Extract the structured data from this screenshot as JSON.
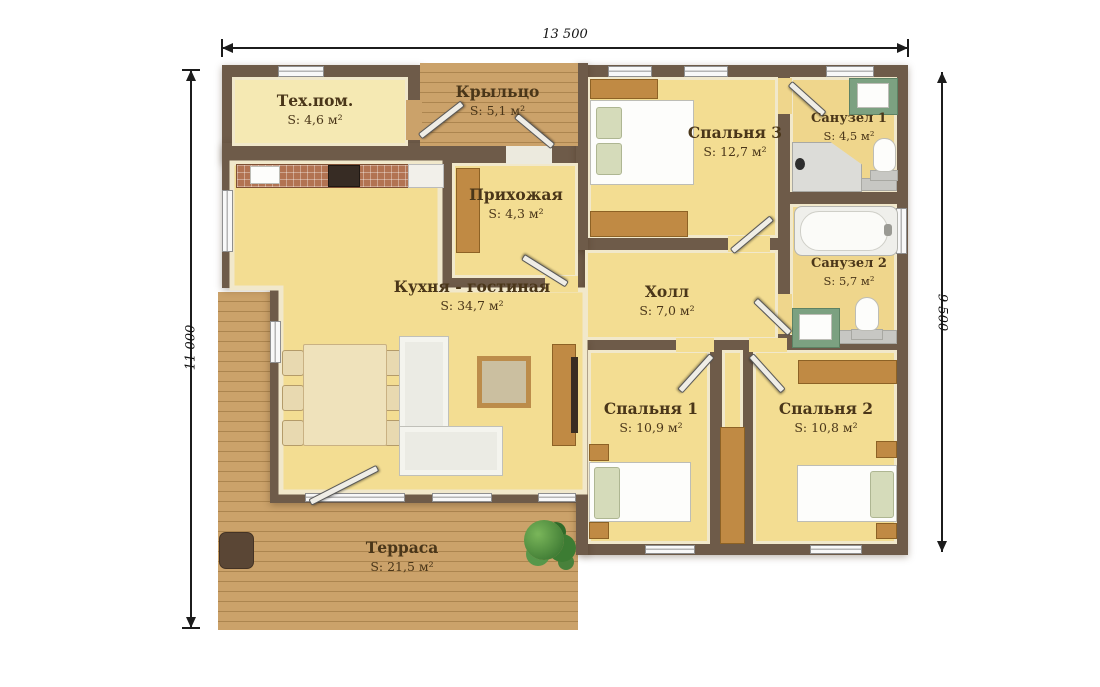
{
  "plan": {
    "title_hint": "house floor plan",
    "dimensions": {
      "top": "13 500",
      "left": "11 000",
      "right": "9 500"
    },
    "rooms": [
      {
        "id": "tech",
        "name": "Тех.пом.",
        "area": "S: 4,6 м²"
      },
      {
        "id": "porch",
        "name": "Крыльцо",
        "area": "S: 5,1 м²"
      },
      {
        "id": "hallway",
        "name": "Прихожая",
        "area": "S: 4,3 м²"
      },
      {
        "id": "bedroom3",
        "name": "Спальня 3",
        "area": "S: 12,7 м²"
      },
      {
        "id": "bath1",
        "name": "Санузел 1",
        "area": "S: 4,5 м²"
      },
      {
        "id": "bath2",
        "name": "Санузел 2",
        "area": "S: 5,7 м²"
      },
      {
        "id": "kitchen",
        "name": "Кухня - гостиная",
        "area": "S: 34,7 м²"
      },
      {
        "id": "hall",
        "name": "Холл",
        "area": "S: 7,0 м²"
      },
      {
        "id": "bedroom1",
        "name": "Спальня 1",
        "area": "S: 10,9 м²"
      },
      {
        "id": "bedroom2",
        "name": "Спальня 2",
        "area": "S: 10,8 м²"
      },
      {
        "id": "terrace",
        "name": "Терраса",
        "area": "S: 21,5 м²"
      }
    ],
    "colors": {
      "wall": "#6e5b49",
      "floor": "#f3dd92",
      "bath_floor": "#efd68c",
      "deck_wood": "#cba26a",
      "furniture_wood": "#c08a44",
      "label_text": "#4a3619",
      "sink_mat_green": "#7ca181",
      "counter_tile": "#b27352"
    }
  }
}
